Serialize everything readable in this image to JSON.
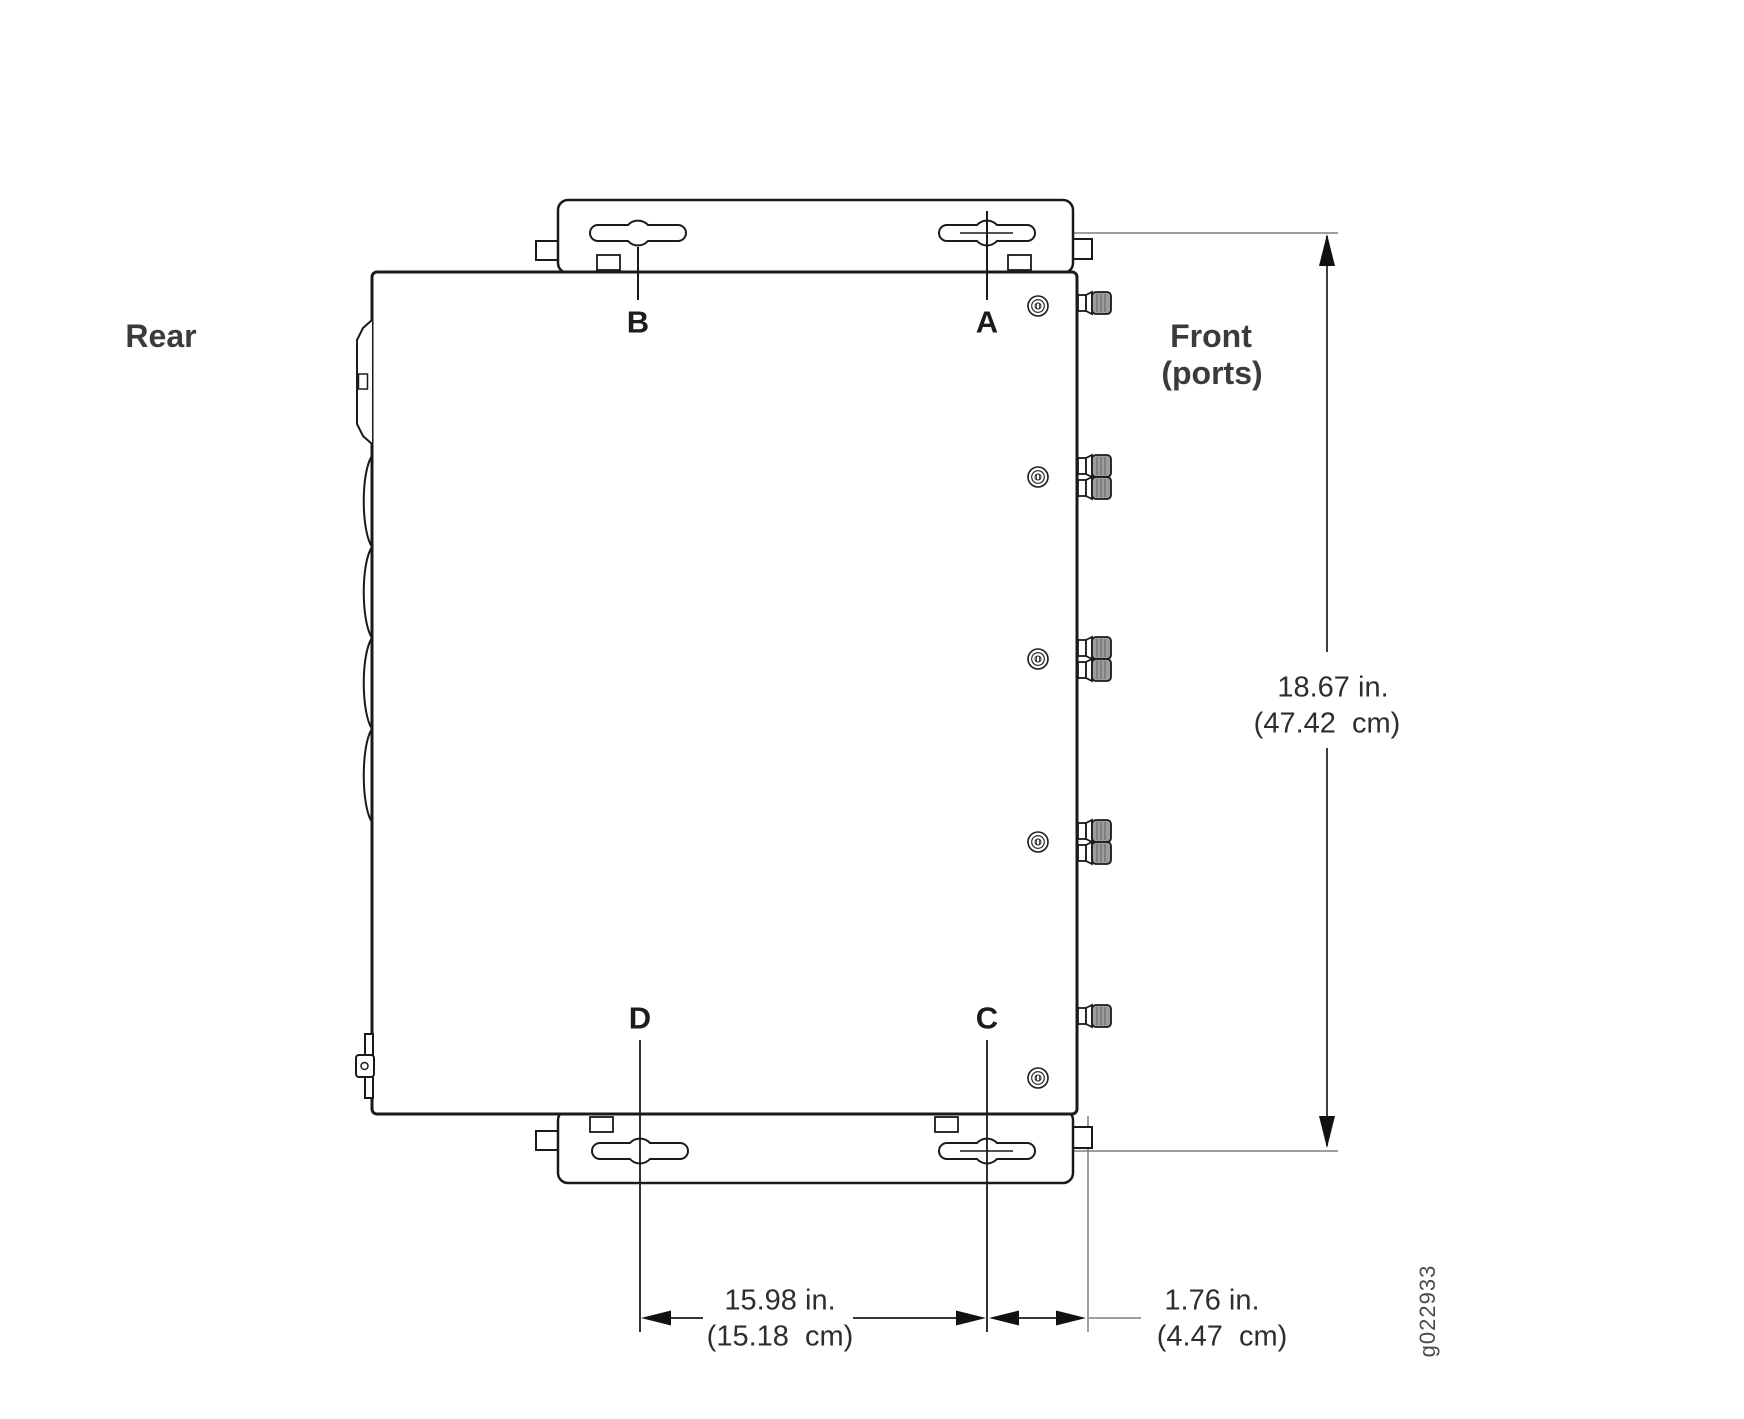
{
  "figure": {
    "type": "chassis-wall-mount-dimension-diagram",
    "labels": {
      "rear": "Rear",
      "front_line1": "Front",
      "front_line2": "(ports)",
      "figure_id": "g022933"
    },
    "mount_hole_labels": {
      "a": "A",
      "b": "B",
      "c": "C",
      "d": "D"
    },
    "dimensions": {
      "chassis_height": {
        "in": "18.67 in.",
        "cm": "(47.42  cm)"
      },
      "keyhole_spacing": {
        "in": "15.98 in.",
        "cm": "(15.18  cm)"
      },
      "front_offset": {
        "in": "1.76 in.",
        "cm": "(4.47  cm)"
      }
    },
    "colors": {
      "line": "#1a1a1a",
      "extension_line": "#7f7f7f",
      "text": "#2e2e2e",
      "connector_fill": "#9d9d9d",
      "background": "#ffffff"
    }
  }
}
